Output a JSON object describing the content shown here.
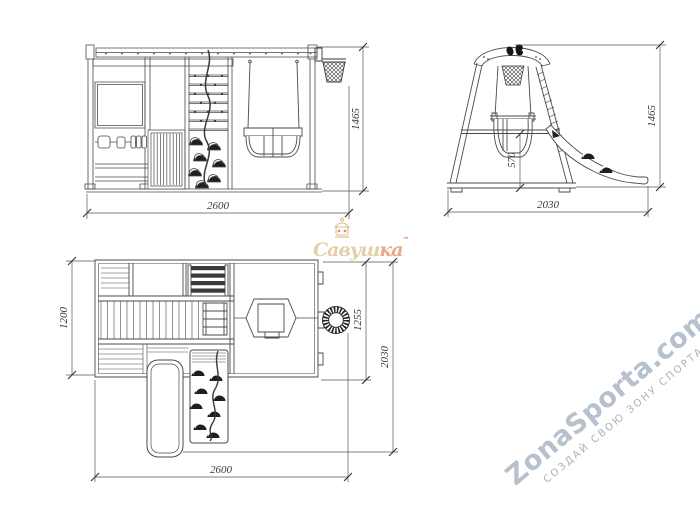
{
  "drawing": {
    "views": {
      "front": {
        "width": "2600",
        "height": "1465"
      },
      "side": {
        "width": "2030",
        "height": "1465",
        "swing_seat_height": "570"
      },
      "plan": {
        "width": "2600",
        "deck_depth": "1200",
        "swing_bay_depth": "1255",
        "total_depth": "2030"
      }
    }
  },
  "watermarks": {
    "brand": {
      "name_start": "Савуш",
      "name_end": "ка",
      "tm": "™"
    },
    "site": {
      "name": "ZonaSporta.com",
      "slogan": "СОЗДАЙ СВОЮ ЗОНУ СПОРТА"
    }
  },
  "colors": {
    "line": "#454545",
    "brand_gold": "#dcbd85",
    "brand_red": "#e05a3a",
    "site_watermark": "#b5c1cd"
  }
}
